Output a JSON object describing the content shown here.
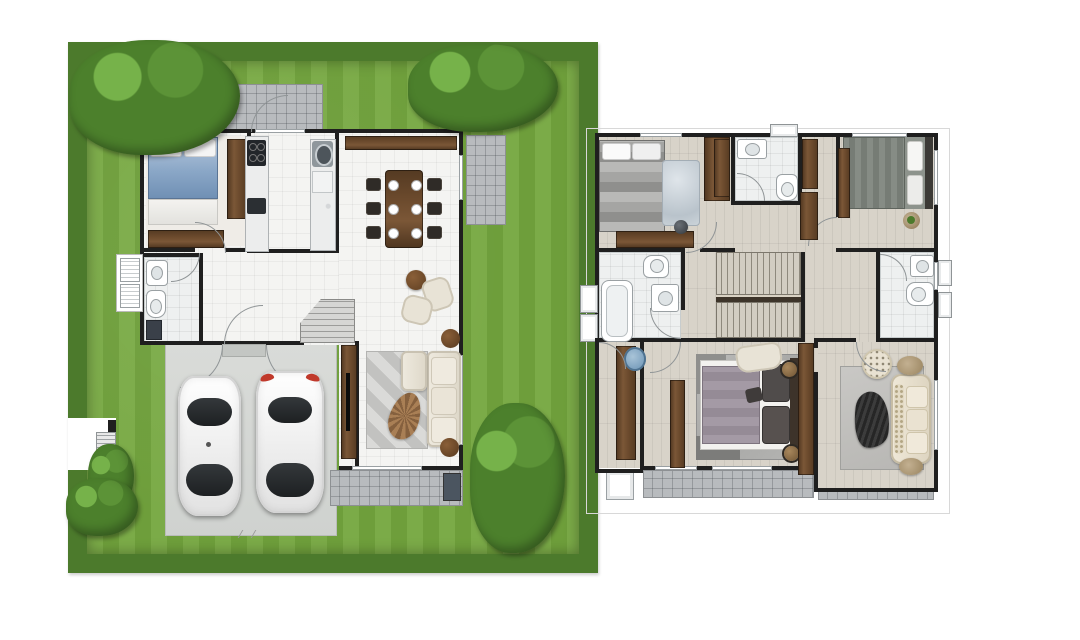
{
  "image": {
    "type": "two-storey-house-floor-plans",
    "floors_shown": 2,
    "visible_text": ""
  },
  "colors": {
    "lawn": "#74a73e",
    "hedge": "#4c7a2c",
    "wall": "#1f1f1f",
    "floor1": "#f4f4f2",
    "patio": "#b8bbbe",
    "concrete": "#d6d8d5",
    "marble": "#eceded",
    "wood-floor": "#d8d3c9",
    "bath": "#eef0f0",
    "bed-blue": "#8aa7c7",
    "sofa": "#e8e3d6",
    "red": "#c0392b",
    "blue-chair": "#7fa3c0",
    "rug": "#c9c9c7"
  },
  "plans": [
    {
      "id": "first-floor",
      "site": [
        "garden-lawn",
        "hedge-border",
        "trees-and-shrubs",
        "garden-gate",
        "driveway"
      ],
      "rooms": [
        "bedroom",
        "bathroom",
        "kitchen",
        "dining-area",
        "living-area",
        "hallway",
        "staircase",
        "garage",
        "roof-patio",
        "side-patio",
        "rear-terrace"
      ],
      "furniture": [
        "double-bed-blue",
        "wardrobe",
        "dresser",
        "stove-counter",
        "sink-counter",
        "dining-table",
        "dining-chairs-x6",
        "lounge-chairs-x2",
        "coffee-table",
        "l-shaped-sofa",
        "area-rug",
        "tv-cabinet",
        "side-tables-x2",
        "washbasin",
        "toilet",
        "shower-mat",
        "ac-units-x2"
      ],
      "vehicles": [
        "white-sedan",
        "white-suv-red-taillights"
      ]
    },
    {
      "id": "second-floor",
      "rooms": [
        "bedroom-front-left",
        "shared-bathroom-front",
        "bedroom-front-right",
        "bathroom-left-with-tub",
        "bathroom-right",
        "hallway",
        "staircase",
        "master-bedroom",
        "sitting-room",
        "balcony"
      ],
      "furniture": [
        "bed-striped-gray",
        "bed-dark-gray",
        "master-bed",
        "wardrobes",
        "dressers",
        "bathtub",
        "toilets-x3",
        "washbasins-x3",
        "armchair",
        "chesterfield-sofa",
        "dotted-ottoman",
        "area-rugs",
        "poufs",
        "round-blue-chair",
        "plant-side-table"
      ]
    }
  ]
}
